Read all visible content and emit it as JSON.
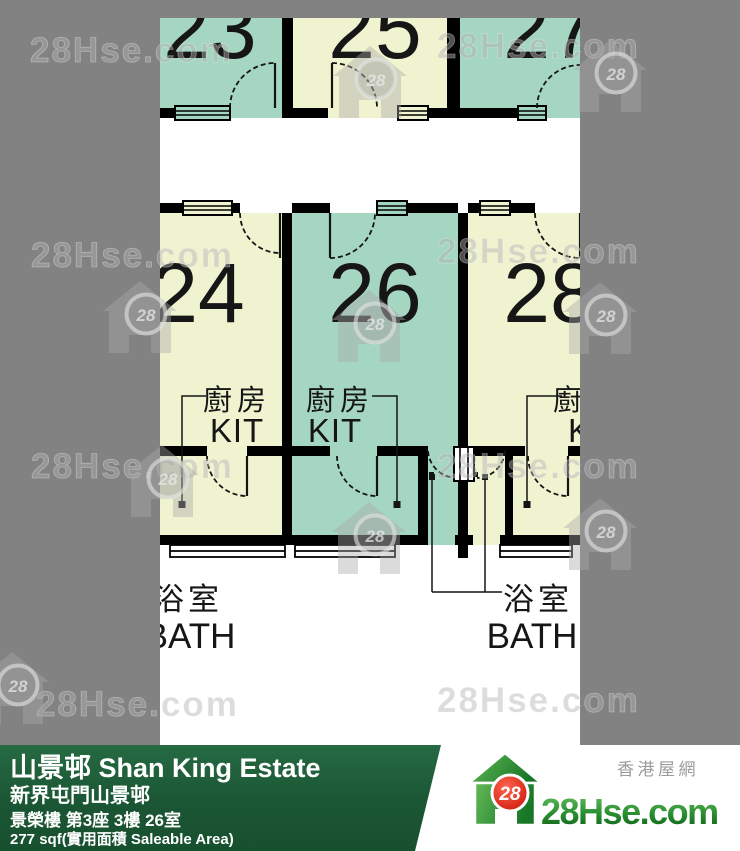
{
  "watermark": {
    "text": "28Hse.com",
    "badge": "28"
  },
  "floor_plan": {
    "top_row_units": [
      {
        "number": "23"
      },
      {
        "number": "25"
      },
      {
        "number": "27"
      }
    ],
    "middle_row_units": [
      {
        "number": "24"
      },
      {
        "number": "26"
      },
      {
        "number": "28"
      }
    ],
    "labels": {
      "kitchen_cn": "廚房",
      "kitchen_en": "KIT",
      "bath_cn": "浴室",
      "bath_en": "BATH"
    },
    "colors": {
      "highlight_teal": "#a5d6c1",
      "room_cream": "#f0f3cf",
      "wall": "#000000"
    }
  },
  "footer": {
    "estate_title": "山景邨 Shan King Estate",
    "district_line": "新界屯門山景邨",
    "block_line": "景榮樓 第3座 3樓 26室",
    "area_line": "277 sqf(實用面積 Saleable Area)",
    "bar_color": "#1d5c37"
  },
  "logo": {
    "badge": "28",
    "site_name": "28Hse.com",
    "tagline": "香港屋網"
  }
}
